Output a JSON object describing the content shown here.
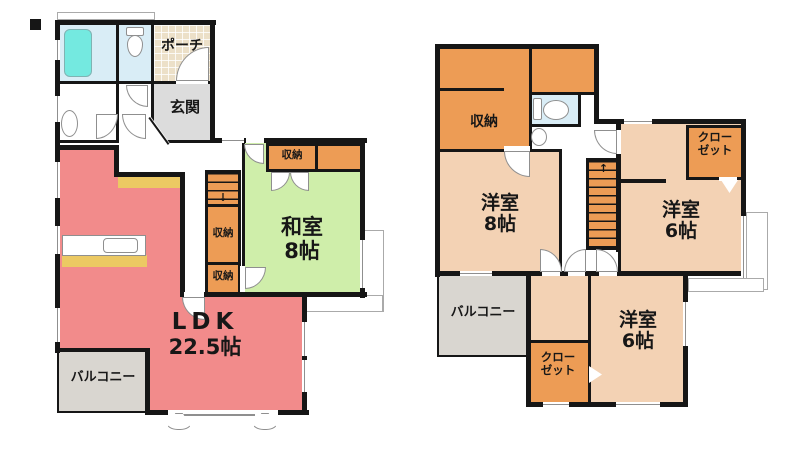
{
  "colors": {
    "wall": "#161616",
    "ldk": "#F28B8B",
    "tatami": "#CFEEAA",
    "western": "#F3D2B4",
    "storage": "#ED9C55",
    "balcony": "#D9D6D0",
    "entrance": "#DCDCDC",
    "bath": "#D9EDF6",
    "tub": "#74E9E0",
    "counter_yellow": "#ECC963",
    "porch": "#ECE0C8"
  },
  "floor1": {
    "porch_label": "ポーチ",
    "entrance_label": "玄関",
    "tatami_room": {
      "line1": "和室",
      "line2": "8帖"
    },
    "ldk": {
      "line1": "LDK",
      "line2": "22.5帖"
    },
    "balcony_label": "バルコニー",
    "storage_upper": "収納",
    "storage_lower": "収納",
    "storage_closet": "収納",
    "stairs_arrow": "↓"
  },
  "floor2": {
    "storage_label": "収納",
    "closet_top": {
      "line1": "クロー",
      "line2": "ゼット"
    },
    "room8": {
      "line1": "洋室",
      "line2": "8帖"
    },
    "room6_right": {
      "line1": "洋室",
      "line2": "6帖"
    },
    "room6_bottom": {
      "line1": "洋室",
      "line2": "6帖"
    },
    "closet_bottom": {
      "line1": "クロー",
      "line2": "ゼット"
    },
    "balcony_label": "バルコニー",
    "stairs_arrow": "↑"
  }
}
